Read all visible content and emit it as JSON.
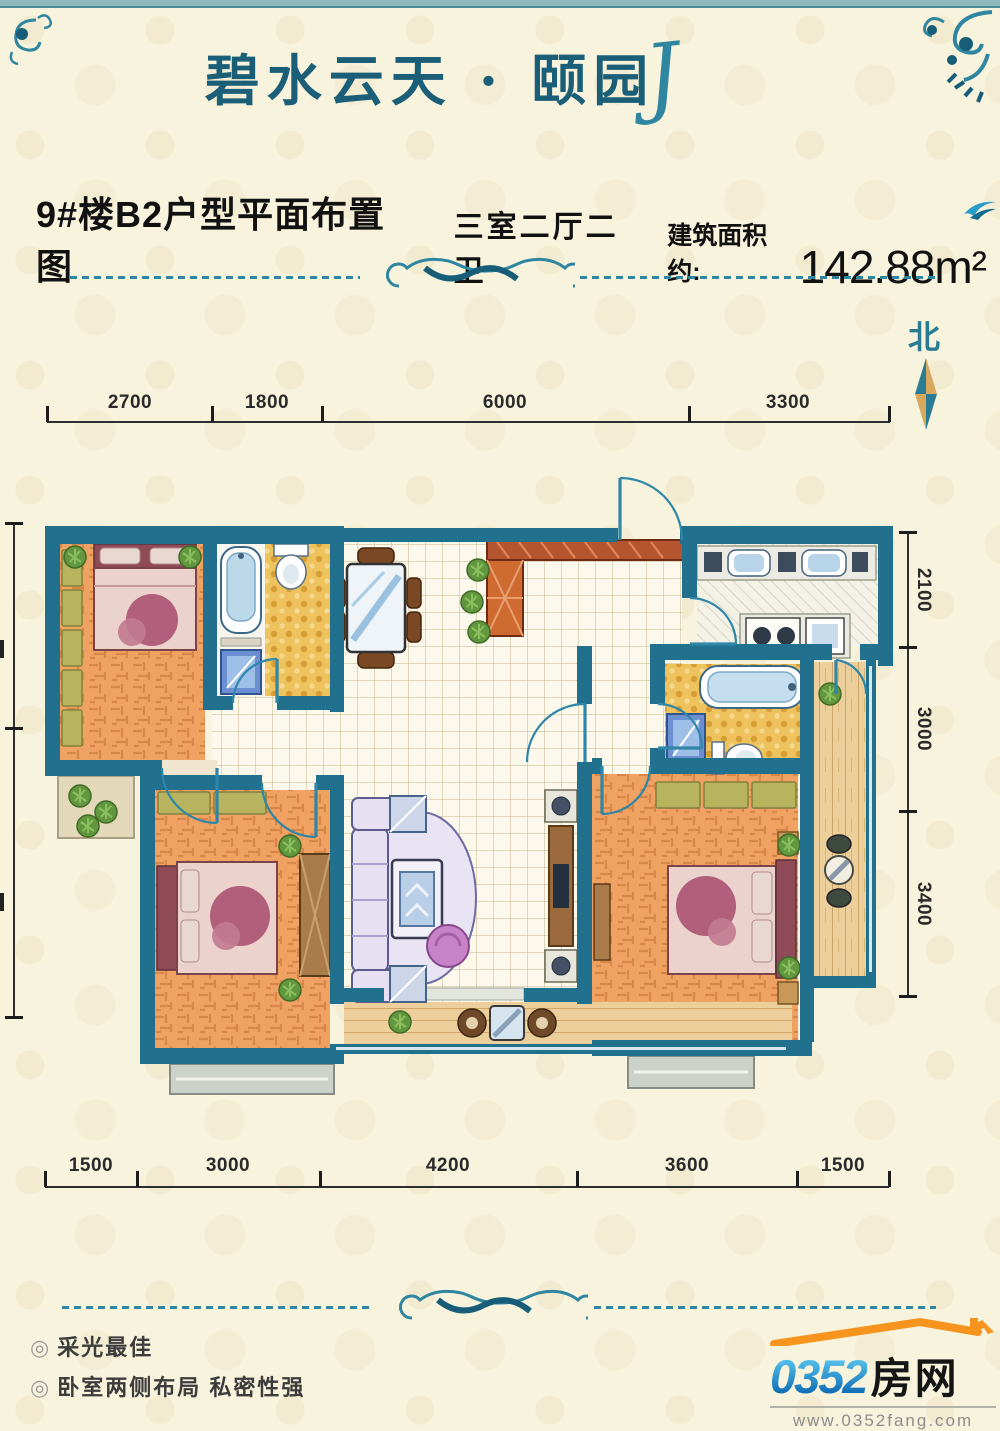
{
  "header": {
    "title": "碧水云天 · 颐园",
    "flourish": "J"
  },
  "spec": {
    "plan_title": "9#楼B2户型平面布置图",
    "rooms": "三室二厅二卫",
    "area_label": "建筑面积约:",
    "area_value": "142.88m²"
  },
  "compass": {
    "north_label": "北"
  },
  "dims": {
    "top": [
      "2700",
      "1800",
      "6000",
      "3300"
    ],
    "right": [
      "2100",
      "3000",
      "3400"
    ],
    "bottom": [
      "1500",
      "3000",
      "4200",
      "3600",
      "1500"
    ]
  },
  "features": {
    "bullet": "◎",
    "item1": "采光最佳",
    "item2": "卧室两侧布局  私密性强"
  },
  "logo": {
    "digits": "0352",
    "word": "房网",
    "url": "www.0352fang.com"
  },
  "colors": {
    "accent_teal": "#2a7c95",
    "wall_teal": "#20708e",
    "logo_orange": "#f7941d"
  }
}
